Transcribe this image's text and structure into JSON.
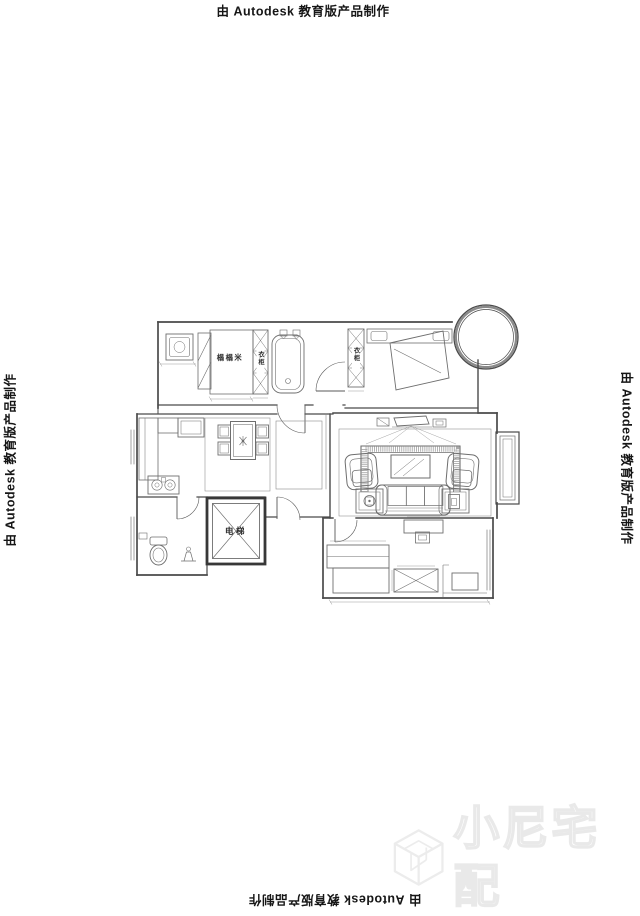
{
  "watermark": {
    "prefix": "由",
    "brand": "Autodesk",
    "suffix": "教育版产品制作"
  },
  "brand_watermark": {
    "logo_text": "小尼宅配",
    "logo_icon": "cube-n-icon",
    "color": "#e9e9e9"
  },
  "floor_plan": {
    "labels": {
      "tatami_room": "榻榻米",
      "wardrobe_hall": "衣柜",
      "wardrobe_master": "衣柜",
      "elevator": "电梯"
    },
    "colors": {
      "wall": "#4a4a4a",
      "furniture": "#6e6e6e",
      "thin_line": "#8a8a8a"
    }
  }
}
